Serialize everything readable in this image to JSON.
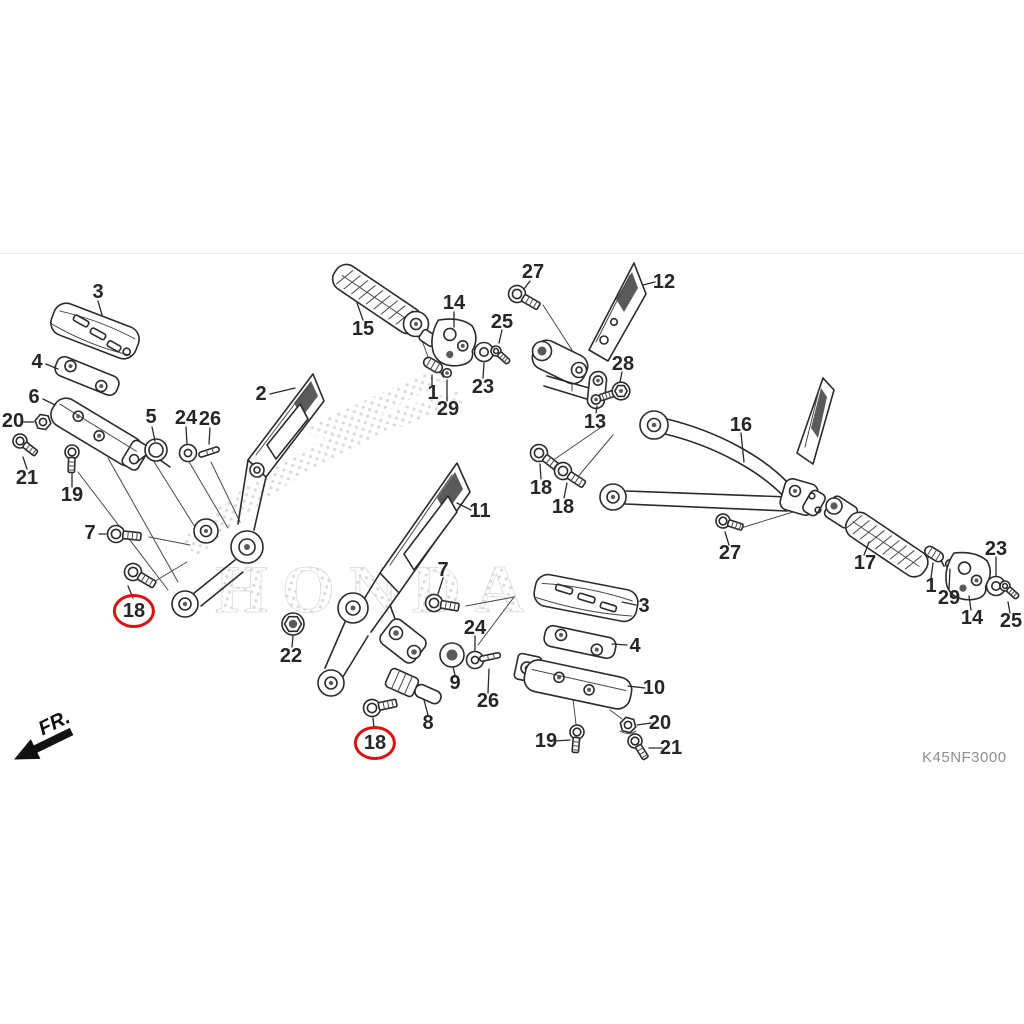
{
  "diagram": {
    "code": "K45NF3000",
    "direction_label": "FR.",
    "watermark_text": "HONDA",
    "highlight_color": "#dd1111",
    "line_color": "#2b2b2b",
    "label_color": "#262626",
    "code_color": "#8f8f8f",
    "background": "#ffffff"
  },
  "labels": [
    {
      "text": "3",
      "x": 98,
      "y": 292
    },
    {
      "text": "4",
      "x": 37,
      "y": 362
    },
    {
      "text": "6",
      "x": 34,
      "y": 397
    },
    {
      "text": "20",
      "x": 13,
      "y": 421
    },
    {
      "text": "21",
      "x": 27,
      "y": 478
    },
    {
      "text": "19",
      "x": 72,
      "y": 495
    },
    {
      "text": "5",
      "x": 151,
      "y": 417
    },
    {
      "text": "24",
      "x": 186,
      "y": 418
    },
    {
      "text": "26",
      "x": 210,
      "y": 419
    },
    {
      "text": "2",
      "x": 261,
      "y": 394
    },
    {
      "text": "7",
      "x": 90,
      "y": 533
    },
    {
      "text": "18",
      "x": 134,
      "y": 611,
      "circled": true
    },
    {
      "text": "22",
      "x": 291,
      "y": 656
    },
    {
      "text": "15",
      "x": 363,
      "y": 329
    },
    {
      "text": "14",
      "x": 454,
      "y": 303
    },
    {
      "text": "25",
      "x": 502,
      "y": 322
    },
    {
      "text": "27",
      "x": 533,
      "y": 272
    },
    {
      "text": "23",
      "x": 483,
      "y": 387
    },
    {
      "text": "1",
      "x": 433,
      "y": 393
    },
    {
      "text": "29",
      "x": 448,
      "y": 409
    },
    {
      "text": "11",
      "x": 480,
      "y": 511
    },
    {
      "text": "7",
      "x": 443,
      "y": 570
    },
    {
      "text": "24",
      "x": 475,
      "y": 628
    },
    {
      "text": "9",
      "x": 455,
      "y": 683
    },
    {
      "text": "26",
      "x": 488,
      "y": 701
    },
    {
      "text": "8",
      "x": 428,
      "y": 723
    },
    {
      "text": "18",
      "x": 375,
      "y": 743,
      "circled": true
    },
    {
      "text": "12",
      "x": 664,
      "y": 282
    },
    {
      "text": "28",
      "x": 623,
      "y": 364
    },
    {
      "text": "13",
      "x": 595,
      "y": 422
    },
    {
      "text": "18",
      "x": 541,
      "y": 488
    },
    {
      "text": "18",
      "x": 563,
      "y": 507
    },
    {
      "text": "16",
      "x": 741,
      "y": 425
    },
    {
      "text": "27",
      "x": 730,
      "y": 553
    },
    {
      "text": "17",
      "x": 865,
      "y": 563
    },
    {
      "text": "1",
      "x": 931,
      "y": 586
    },
    {
      "text": "29",
      "x": 949,
      "y": 598
    },
    {
      "text": "14",
      "x": 972,
      "y": 618
    },
    {
      "text": "23",
      "x": 996,
      "y": 549
    },
    {
      "text": "25",
      "x": 1011,
      "y": 621
    },
    {
      "text": "3",
      "x": 644,
      "y": 606
    },
    {
      "text": "4",
      "x": 635,
      "y": 646
    },
    {
      "text": "10",
      "x": 654,
      "y": 688
    },
    {
      "text": "20",
      "x": 660,
      "y": 723
    },
    {
      "text": "19",
      "x": 546,
      "y": 741
    },
    {
      "text": "21",
      "x": 671,
      "y": 748
    }
  ]
}
